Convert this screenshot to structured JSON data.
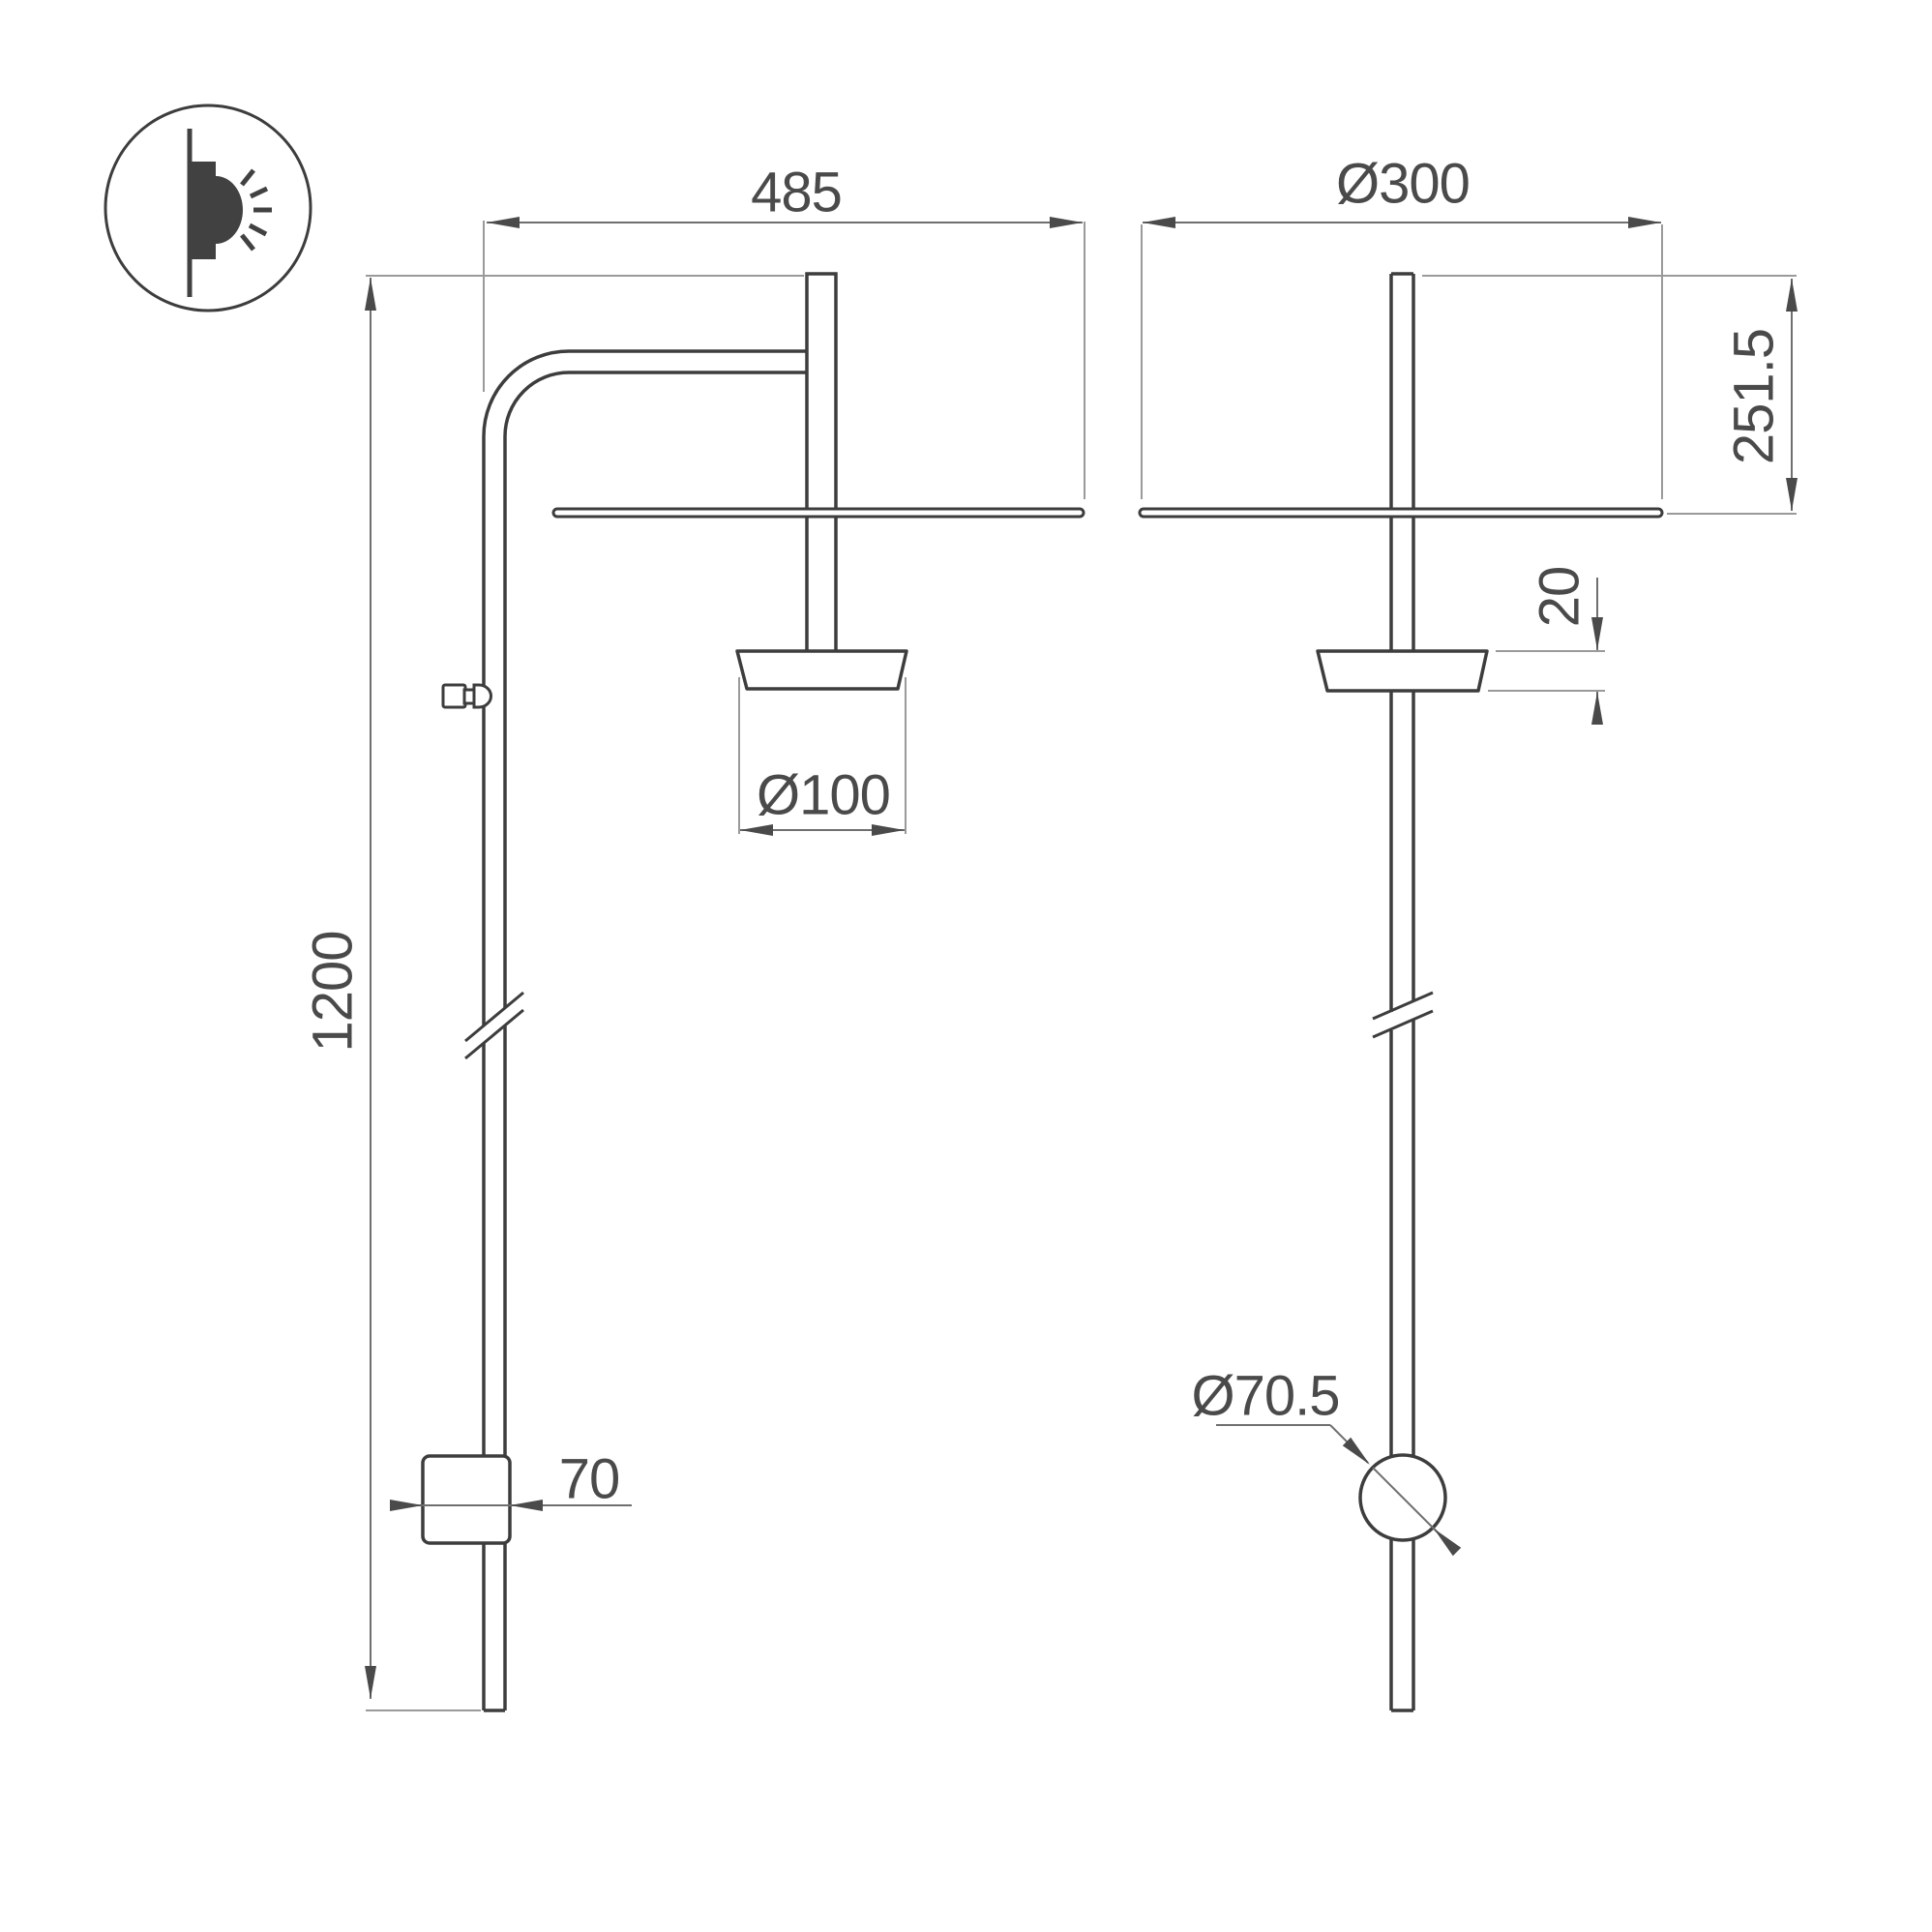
{
  "drawing": {
    "type": "technical-dimension-drawing",
    "product": "wall-mounted-light-fixture",
    "icon": "wall-light-icon"
  },
  "colors": {
    "background": "#ffffff",
    "object_line": "#3d3d3d",
    "dimension_line": "#6f6f6f",
    "extension_line": "#9a9a9a",
    "text": "#4a4a4a"
  },
  "dimensions": {
    "arm_width": {
      "label": "485"
    },
    "total_height": {
      "label": "1200"
    },
    "head_diameter": {
      "label": "Ø100"
    },
    "box_width": {
      "label": "70"
    },
    "disc_diameter": {
      "label": "Ø300"
    },
    "top_to_disc": {
      "label": "251.5"
    },
    "head_thickness": {
      "label": "20"
    },
    "mount_diameter": {
      "label": "Ø70.5"
    }
  }
}
